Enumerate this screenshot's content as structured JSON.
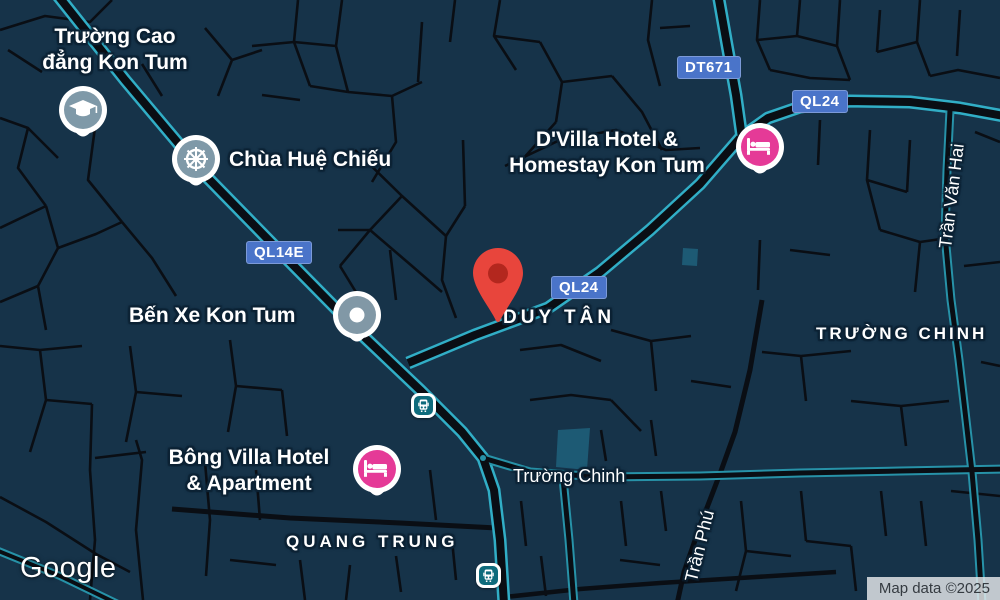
{
  "map": {
    "logo": "Google",
    "attribution": "Map data ©2025",
    "badges": {
      "ql14e": "QL14E",
      "ql24_center": "QL24",
      "ql24_northeast": "QL24",
      "dt671": "DT671"
    },
    "pois": {
      "college": {
        "line1": "Trường Cao",
        "line2": "đẳng Kon Tum",
        "icon": "graduation-cap"
      },
      "pagoda": {
        "name": "Chùa Huệ Chiếu",
        "icon": "dharma-wheel"
      },
      "dvilla_hotel": {
        "line1": "D'Villa Hotel &",
        "line2": "Homestay Kon Tum",
        "icon": "hotel-bed"
      },
      "bus_station": {
        "name": "Bến Xe Kon Tum",
        "icon": "place-dot"
      },
      "bong_villa_hotel": {
        "line1": "Bông Villa Hotel",
        "line2": "& Apartment",
        "icon": "hotel-bed"
      }
    },
    "area_labels": {
      "duy_tan": "DUY TÂN",
      "quang_trung": "QUANG TRUNG",
      "truong_chinh": "TRƯỜNG CHINH"
    },
    "street_labels": {
      "truong_chinh": "Trường Chinh",
      "tran_van_hai": "Trần Văn Hai",
      "tran_phu": "Trần Phú"
    },
    "markers": {
      "destination": "red-pin",
      "transit_stops": [
        "bus",
        "bus"
      ]
    },
    "colors": {
      "background": "#163349",
      "street": "#0a0e14",
      "highway_casing": "#31aec6",
      "minor_highway_casing": "#2792a8",
      "badge_blue": "#4a74c9",
      "label_halo": "#0c2234",
      "poi_slate": "#7f99a8",
      "hotel_pink": "#e53a97",
      "transit_teal": "#0e6b7c",
      "pin_red": "#e8453c",
      "pin_red_inner": "#b3271e",
      "area_fill": "#1d5a74",
      "attribution_text": "#353b41"
    }
  }
}
